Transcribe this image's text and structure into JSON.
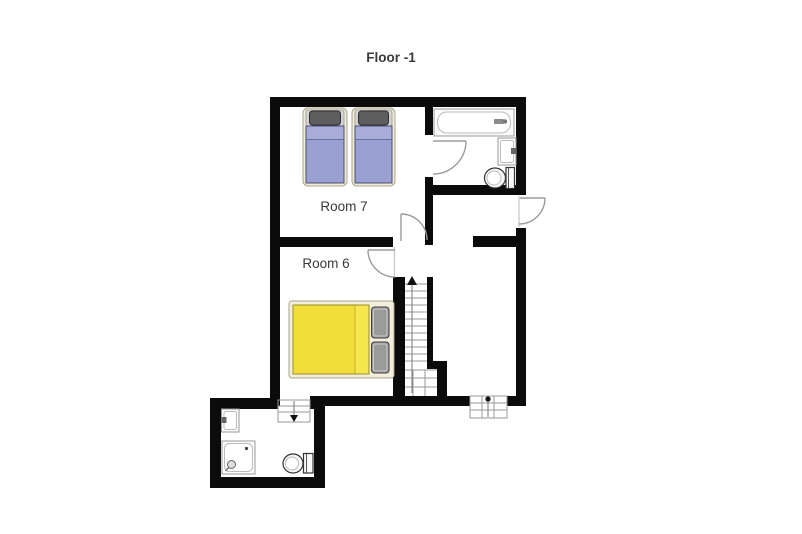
{
  "title": "Floor -1",
  "rooms": [
    {
      "id": "room-7",
      "label": "Room 7",
      "beds": [
        "single-bed",
        "single-bed"
      ]
    },
    {
      "id": "room-6",
      "label": "Room 6",
      "beds": [
        "double-bed"
      ]
    }
  ],
  "bathrooms": [
    {
      "id": "bathroom-upper-right",
      "fixtures": [
        "bathtub",
        "sink",
        "toilet"
      ]
    },
    {
      "id": "bathroom-lower-left",
      "fixtures": [
        "sink",
        "shower",
        "toilet"
      ]
    }
  ],
  "stairs": [
    {
      "id": "main-staircase",
      "direction": "up"
    },
    {
      "id": "exterior-steps",
      "direction": "down"
    },
    {
      "id": "bathroom-steps",
      "direction": "down"
    }
  ],
  "doors": [
    "bathroom-upper-door",
    "hall-exterior-door",
    "room-7-door",
    "room-6-door"
  ],
  "colors": {
    "wall": "#0b0b0b",
    "door": "#9b9b9b",
    "stair_line": "#9a9a9a",
    "text": "#3a3a3a",
    "bed_frame": "#eeebd8",
    "bed_blue": "#9aa0d2",
    "bed_blue_fold": "#a8add9",
    "bed_yellow": "#f2de3b",
    "bed_yellow_fold": "#f6e64f",
    "pillow_dark": "#5e5e5e",
    "pillow_gray": "#9b9b9b"
  }
}
